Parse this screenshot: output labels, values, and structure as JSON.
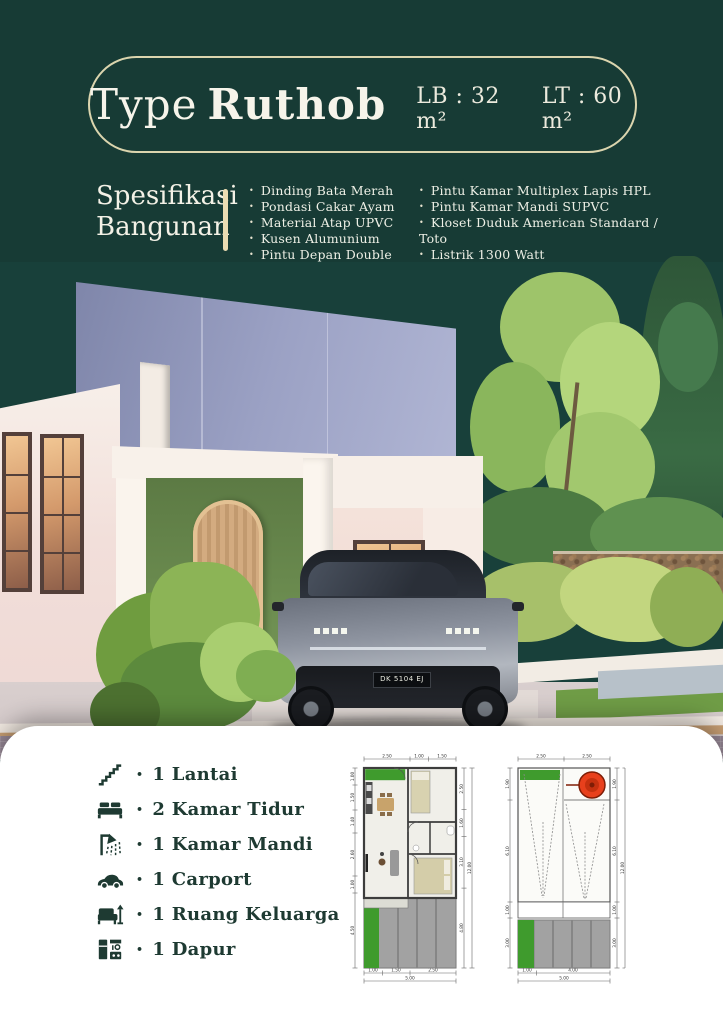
{
  "header": {
    "title_regular": "Type",
    "title_bold": "Ruthob",
    "lb": "LB : 32 m²",
    "lt": "LT : 60 m²"
  },
  "spec": {
    "heading_line1": "Spesifikasi",
    "heading_line2": "Bangunan",
    "col1": [
      "Dinding Bata Merah",
      "Pondasi Cakar Ayam",
      "Material Atap UPVC",
      "Kusen Alumunium",
      "Pintu Depan Double Plywood"
    ],
    "col2": [
      "Pintu Kamar Multiplex Lapis HPL",
      "Pintu Kamar Mandi SUPVC",
      "Kloset Duduk American Standard / Toto",
      "Listrik 1300 Watt",
      "Air Sumur Bor"
    ]
  },
  "features": [
    {
      "icon": "stairs-icon",
      "label": "1 Lantai"
    },
    {
      "icon": "bed-icon",
      "label": "2 Kamar Tidur"
    },
    {
      "icon": "shower-icon",
      "label": "1 Kamar Mandi"
    },
    {
      "icon": "car-icon",
      "label": "1 Carport"
    },
    {
      "icon": "sofa-icon",
      "label": "1 Ruang Keluarga"
    },
    {
      "icon": "kitchen-icon",
      "label": "1 Dapur"
    }
  ],
  "photo": {
    "license_plate": "DK 5104 EJ"
  },
  "plan1": {
    "top_dims": [
      "2.50",
      "1.00",
      "1.50"
    ],
    "left_dims": [
      "1.00",
      "1.50",
      "1.40",
      "2.60",
      "1.00",
      "4.50"
    ],
    "right_dims": [
      "2.50",
      "1.60",
      "3.10",
      "4.80"
    ],
    "side_total": "12.00",
    "bottom_dims": [
      "1.00",
      "1.50",
      "2.50"
    ],
    "bottom_total": "5.00"
  },
  "plan2": {
    "top_dims": [
      "2.50",
      "2.50"
    ],
    "left_dims": [
      "1.90",
      "6.10",
      "1.00",
      "3.00"
    ],
    "right_dims": [
      "1.90",
      "6.10",
      "1.00",
      "3.00"
    ],
    "side_total": "12.00",
    "bottom_dims": [
      "1.00",
      "4.00"
    ],
    "bottom_total": "5.00"
  },
  "colors": {
    "background_green": "#173B35",
    "border_cream": "#DBD5AE",
    "divider_tan": "#EBDCB2",
    "text_light": "#F3F1E6",
    "text_dark": "#1E3A32",
    "card_white": "#FFFFFF",
    "plan_green": "#3F9B2D",
    "tank_red": "#E8401C",
    "accent_wall_green": "#6F9052",
    "facade_blue": "#9BA1C4"
  }
}
